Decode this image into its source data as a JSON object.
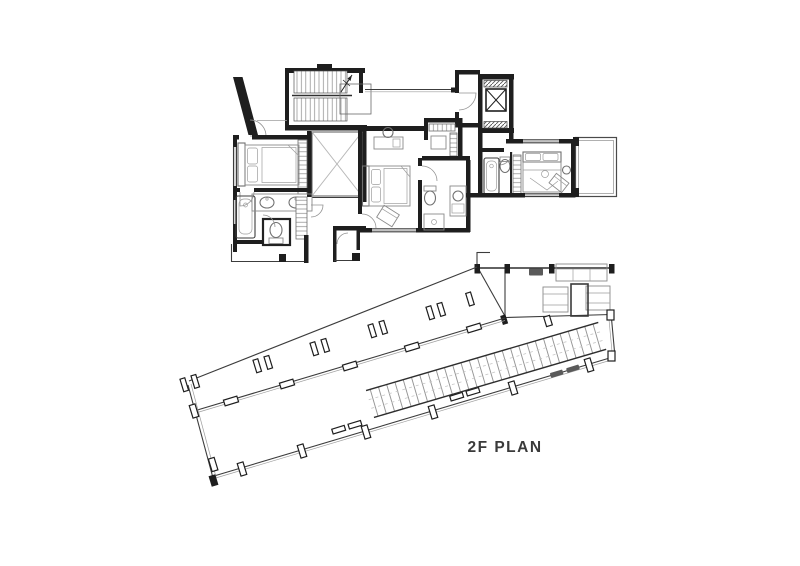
{
  "title": "2F PLAN",
  "drawing": {
    "type": "architectural floor plan",
    "floor": "2F",
    "colors": {
      "background": "#ffffff",
      "walls": "#1e1e1e",
      "thin_lines": "#3c3c3c",
      "furniture_lines": "#8a8a8a",
      "hatch_lines": "#8a8a8a",
      "title_text": "#3a3a3a"
    },
    "elements": [
      "staircase",
      "elevator",
      "elevator-lobby",
      "void-over-below",
      "master-bedroom",
      "master-bathroom",
      "wc",
      "lower-terrace",
      "bedroom-2",
      "walk-in-closet",
      "bathroom-2",
      "bedroom-3",
      "bathroom-3",
      "closet-strip",
      "balcony",
      "roof-deck",
      "deck-terrace",
      "outdoor-lounge-set",
      "pergola-walkway",
      "deck-columns"
    ]
  }
}
